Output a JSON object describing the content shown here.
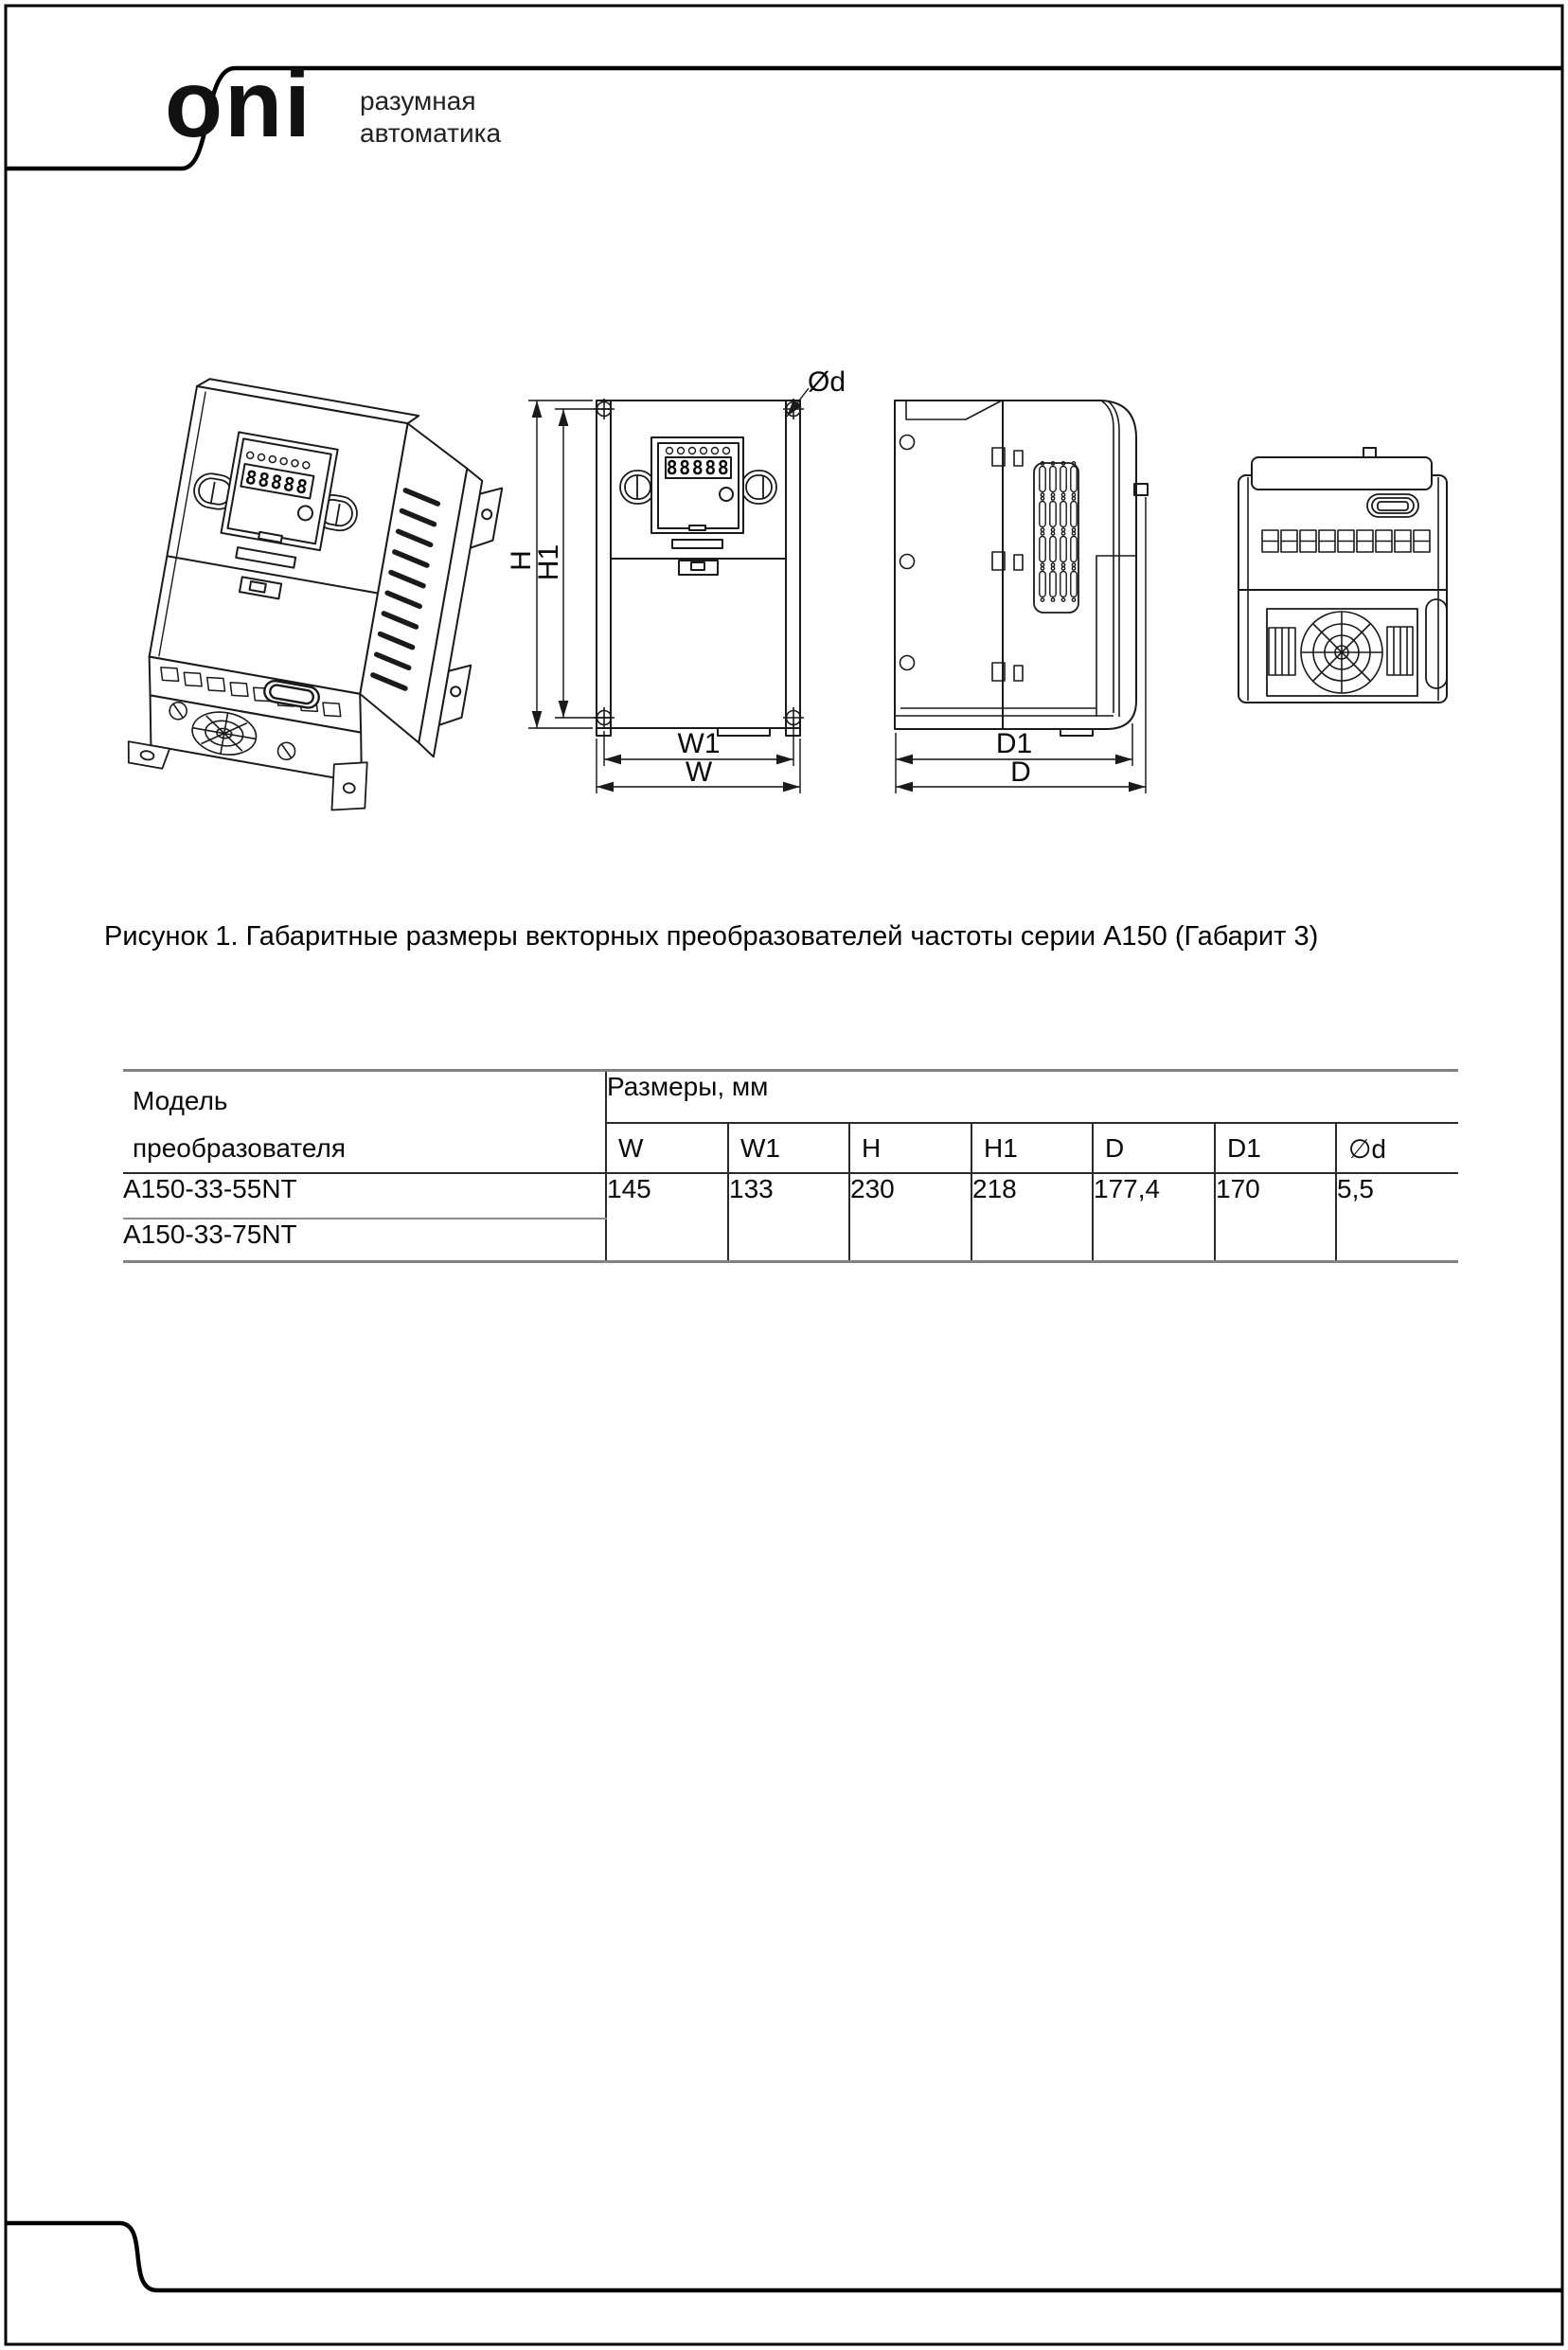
{
  "brand": {
    "logo": "oni",
    "tagline_line1": "разумная",
    "tagline_line2": "автоматика"
  },
  "figure": {
    "caption": "Рисунок 1. Габаритные размеры векторных преобразователей частоты серии А150 (Габарит 3)",
    "keypad_display_value": "88888",
    "dimension_labels": {
      "h": "H",
      "h1": "H1",
      "w": "W",
      "w1": "W1",
      "d": "D",
      "d1": "D1",
      "diameter": "Ød"
    }
  },
  "table": {
    "model_header_line1": "Модель",
    "model_header_line2": "преобразователя",
    "dimensions_group_header": "Размеры, мм",
    "columns": [
      "W",
      "W1",
      "H",
      "H1",
      "D",
      "D1",
      "∅d"
    ],
    "rows": [
      {
        "model": "A150-33-55NT",
        "values": [
          "145",
          "133",
          "230",
          "218",
          "177,4",
          "170",
          "5,5"
        ]
      },
      {
        "model": "A150-33-75NT"
      }
    ]
  }
}
